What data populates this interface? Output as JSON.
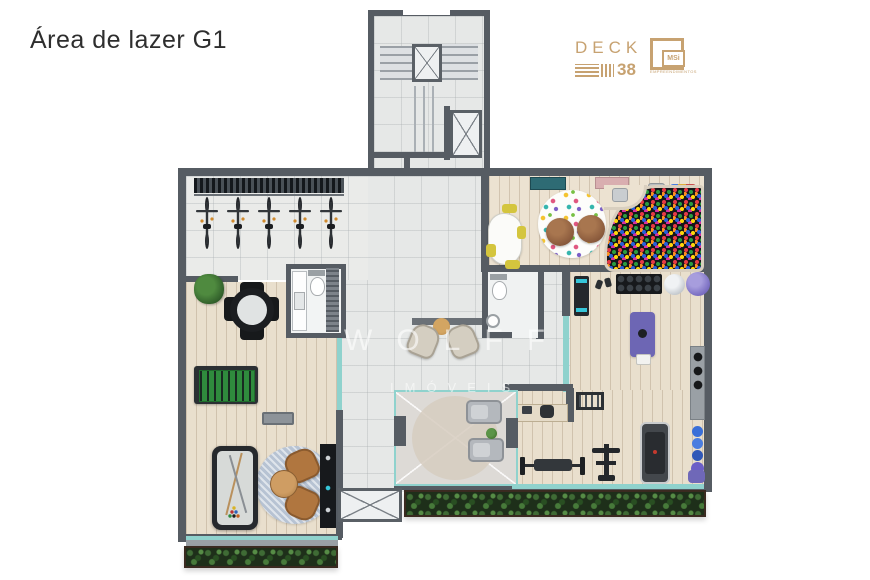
{
  "page": {
    "title": "Área de lazer G1"
  },
  "branding": {
    "deck": {
      "name": "DECK",
      "number": "38",
      "color": "#c7a271"
    },
    "msi": {
      "text": "MSi",
      "subtext": "EMPREENDIMENTOS"
    }
  },
  "watermark": {
    "line1": "WOLFF",
    "line2": "IMÓVEIS"
  },
  "floorplan": {
    "bike_count": 5,
    "colors": {
      "wall": "#565c63",
      "wood_floor": "#e9dfcd",
      "tile_floor": "#e6e8e7",
      "glass": "#8fd2cd",
      "hedge_green": "#3f6b35",
      "ball_pit_base": "#15161a",
      "yoga_mat_purple": "#6d66b4",
      "gym_ball_purple": "#7a6ec2",
      "rug_blue": "#b7c3d3",
      "armchair_tan": "#b0763f",
      "foosball_green": "#2f8b3d"
    },
    "areas": [
      {
        "id": "stair-core",
        "items": [
          "stairs",
          "elevator",
          "elevator"
        ]
      },
      {
        "id": "bike-room",
        "items": [
          "wall-rack",
          "bicycles"
        ]
      },
      {
        "id": "kids-playroom",
        "items": [
          "kids-table",
          "kids-chairs",
          "polka-dot-rug",
          "bean-bags",
          "ball-pit",
          "toy-shelf",
          "toys"
        ]
      },
      {
        "id": "games-room",
        "items": [
          "plant",
          "dining-table",
          "chairs",
          "foosball-table",
          "bench",
          "pool-table",
          "round-rug",
          "armchairs",
          "coffee-table",
          "bar-counter"
        ]
      },
      {
        "id": "bathroom-a",
        "items": [
          "vanity",
          "toilet",
          "duct-shaft"
        ]
      },
      {
        "id": "bathroom-b",
        "items": [
          "toilet",
          "round-sink"
        ]
      },
      {
        "id": "lounge-hall",
        "items": [
          "console-table",
          "armchairs",
          "side-table"
        ]
      },
      {
        "id": "gym",
        "items": [
          "wall-board",
          "dumbbells",
          "dumbbell-rack",
          "gym-ball-silver",
          "gym-ball-purple",
          "yoga-mat",
          "desk",
          "desk-chair",
          "squat-rack",
          "weight-bench",
          "barbell",
          "exercise-machine",
          "treadmill",
          "storage-shelf",
          "medicine-balls",
          "kettlebell",
          "rolled-mat"
        ]
      },
      {
        "id": "terrace",
        "items": [
          "open-to-below-cross",
          "round-rug",
          "loungers",
          "plant"
        ]
      },
      {
        "id": "shaft",
        "items": [
          "open-to-below-cross"
        ]
      },
      {
        "id": "planters",
        "items": [
          "hedges"
        ]
      }
    ]
  }
}
